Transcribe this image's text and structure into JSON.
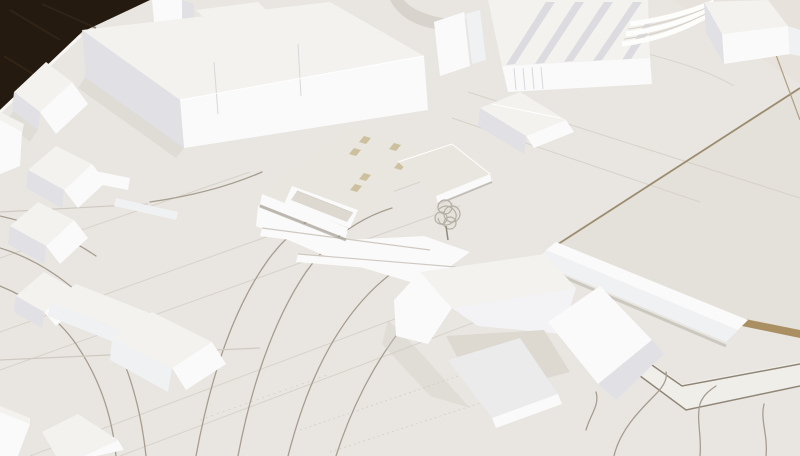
{
  "meta": {
    "description": "Photograph of a white architectural scale model on a table: massing blocks, gabled houses, engraved roads, central slab building with tan skylights, wire tree, dark table corner visible top-left."
  },
  "colors": {
    "base": "#e9e6e1",
    "plate": "#e4e0da",
    "plate2": "#e7e3dc",
    "plate_light": "#f0eee9",
    "table": "#241a10",
    "table_streak": "#3d2c1a",
    "edge_light": "#f7f6f2",
    "top": "#f3f2ef",
    "top2": "#ebebeb",
    "bright": "#fafafa",
    "bright2": "#f3f3f5",
    "lit": "#f0f1f3",
    "shade": "#e0e0e5",
    "slab_top": "#e9e6df",
    "court": "#ddd9d1",
    "skylight": "#cdc09e",
    "blue_slab": "#c6c9cf",
    "road": "#a69d90",
    "faint": "#d7d2c9",
    "joint": "#cfc9c1",
    "seam": "#9c8c6f",
    "seam2": "#b0a084",
    "corner_line": "#8f8677",
    "card_edge": "#aa8f63",
    "grey_band": "#d8d4cd",
    "rib": "#dcdce0",
    "facade_line": "#d8d8dc",
    "shadow": "#cfcac2",
    "shadow_line": "#948e84",
    "tree_stroke": "#b5afa5",
    "tree_fill": "#e3dfd8",
    "trunk": "#8f897f"
  },
  "scene": {
    "regions": [
      {
        "name": "table-corner",
        "label": "dark wooden table surface beyond model edge"
      },
      {
        "name": "model-base",
        "label": "warm white site board with engraved roads"
      },
      {
        "name": "tl-block",
        "label": "large L-shaped massing block, top left"
      },
      {
        "name": "tl-houses",
        "label": "gabled and hipped houses, left side"
      },
      {
        "name": "central-site",
        "label": "central slab building with skylights, sunken court, plinth and wire tree"
      },
      {
        "name": "industrial-roofs",
        "label": "sawtooth-roof industrial halls, top center-right"
      },
      {
        "name": "terraced-block",
        "label": "block with terraced steps, top right"
      },
      {
        "name": "right-plate",
        "label": "raised cardboard site plate with seams, right side"
      },
      {
        "name": "long-bar",
        "label": "long white bar building on plate"
      },
      {
        "name": "faceted-complex",
        "label": "large faceted courtyard building, bottom center"
      },
      {
        "name": "row-houses",
        "label": "row of pitched-roof houses, bottom left"
      },
      {
        "name": "plate-corner",
        "label": "layered plate corner with wavy paths, bottom right"
      }
    ]
  }
}
